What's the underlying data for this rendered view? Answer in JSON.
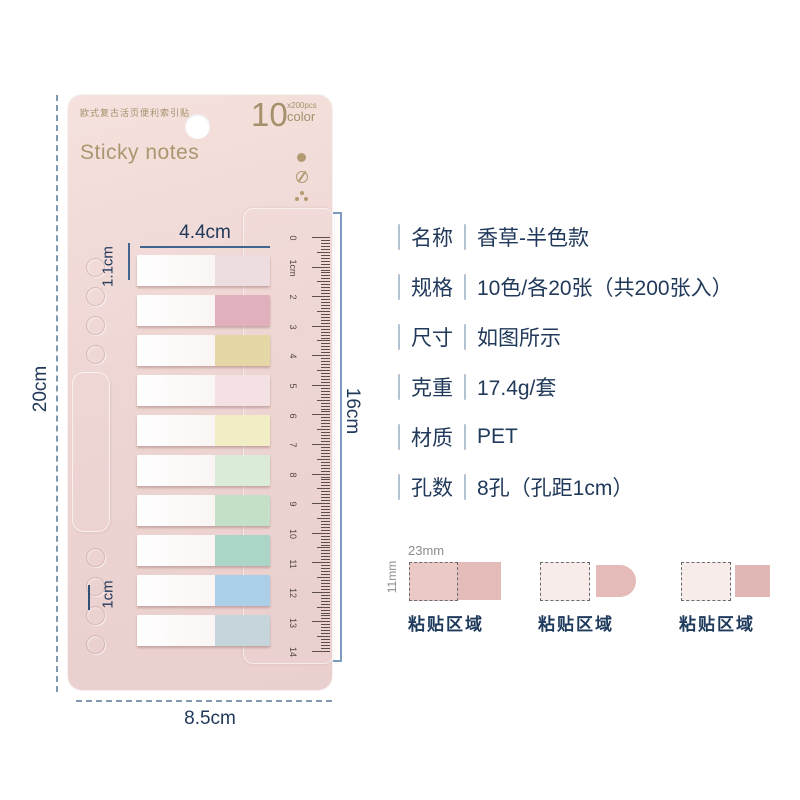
{
  "package": {
    "top_text": "欧式复古活页便利索引贴",
    "count_big": "10",
    "count_small": "x200pcs",
    "count_unit": "color",
    "title": "Sticky notes",
    "tab_colors": [
      "#eddce0",
      "#e2afbc",
      "#e5d8a6",
      "#f3e1e3",
      "#f1eec5",
      "#daecd8",
      "#c4e0c7",
      "#abd5c7",
      "#abcfe8",
      "#c6d4dc"
    ],
    "ruler_numbers": [
      "0",
      "1cm",
      "2",
      "3",
      "4",
      "5",
      "6",
      "7",
      "8",
      "9",
      "10",
      "11",
      "12",
      "13",
      "14"
    ]
  },
  "dimensions": {
    "tab_width": "4.4cm",
    "tab_height": "1.1cm",
    "card_height": "20cm",
    "card_width": "8.5cm",
    "ruler_length": "16cm",
    "hole_pitch": "1cm"
  },
  "specs": {
    "rows": [
      {
        "label": "名称",
        "value": "香草-半色款"
      },
      {
        "label": "规格",
        "value": "10色/各20张（共200张入）"
      },
      {
        "label": "尺寸",
        "value": "如图所示"
      },
      {
        "label": "克重",
        "value": "17.4g/套"
      },
      {
        "label": "材质",
        "value": "PET"
      },
      {
        "label": "孔数",
        "value": "8孔（孔距1cm）"
      }
    ]
  },
  "adhesive_diagrams": {
    "width_label": "23mm",
    "height_label": "11mm",
    "caption": "粘贴区域"
  },
  "colors": {
    "card_pink": "#eed6d3",
    "gold": "#a5906b",
    "navy": "#1f3a5e",
    "annotation_blue": "#41658e",
    "dash_gray_blue": "#8099ae",
    "adhesive_pink": "#e3bbb8"
  }
}
